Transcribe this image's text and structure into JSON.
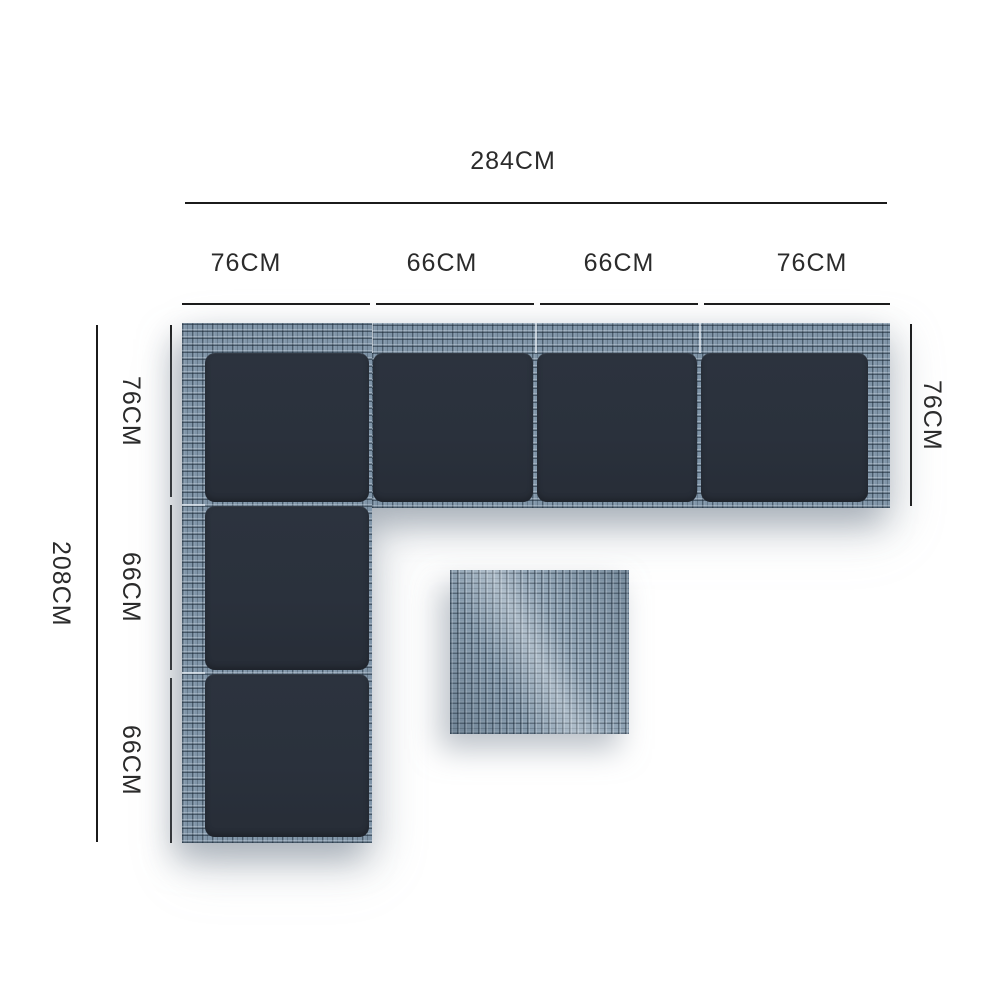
{
  "diagram": {
    "unit": "CM",
    "colors": {
      "background": "#ffffff",
      "dimension_line": "#1b1b1b",
      "label_text": "#2b2b2b",
      "cushion": "#2a313c",
      "rattan_frame": "#7f94a7",
      "side_table": "#8ba0b2"
    },
    "dimensions": {
      "top_total": "284CM",
      "top_segments": [
        "76CM",
        "66CM",
        "66CM",
        "76CM"
      ],
      "left_total": "208CM",
      "left_segments": [
        "76CM",
        "66CM",
        "66CM"
      ],
      "right_depth": "76CM"
    },
    "sofa": {
      "top_row_cushions": 4,
      "left_column_cushions": 3,
      "has_side_table": true
    }
  }
}
